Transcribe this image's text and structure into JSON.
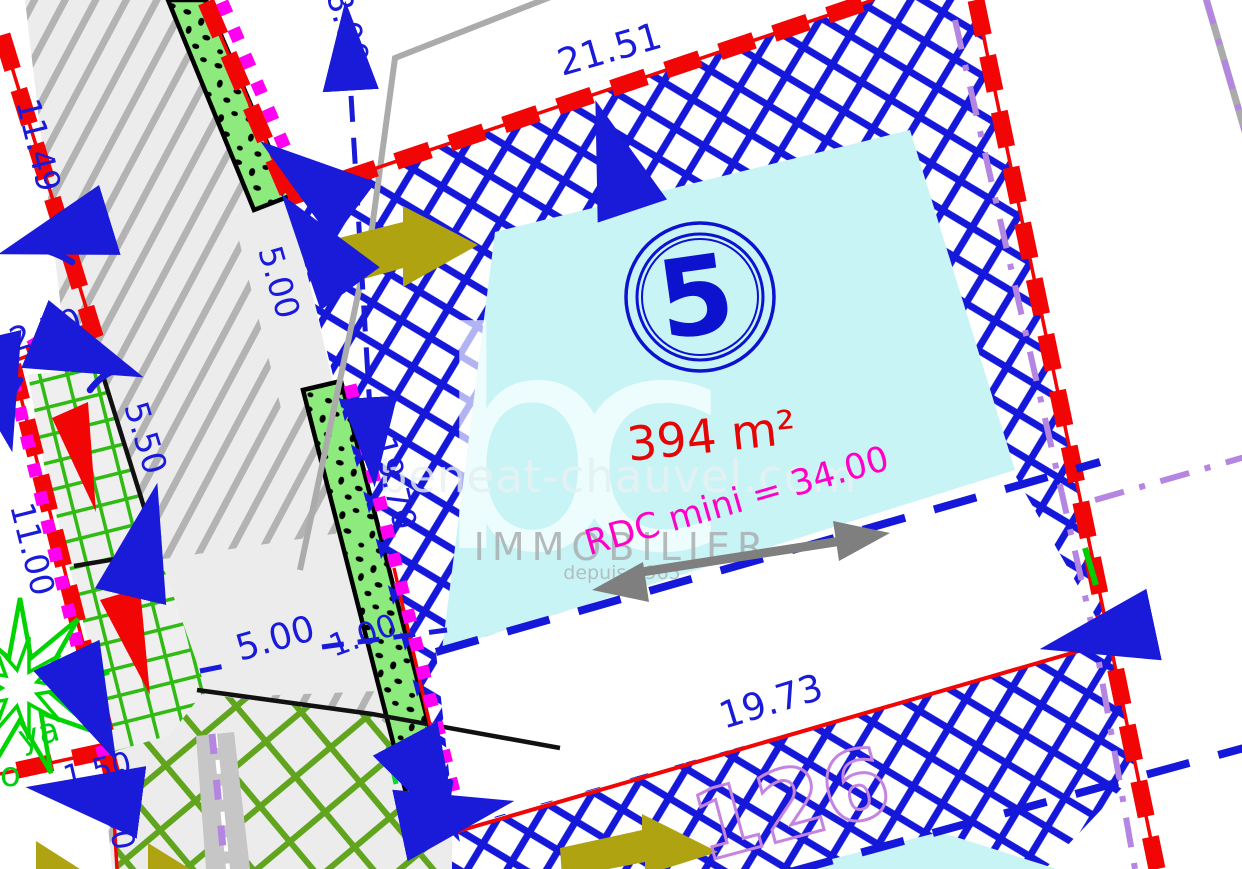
{
  "plan": {
    "lot": {
      "number": "5",
      "area": "394 m²",
      "constraint": "RDC mini = 34.00"
    },
    "adjacent_lot_number": "126",
    "dimensions": {
      "top_setback": "8.00",
      "north_boundary": "21.51",
      "west_boundary_1": "11.49",
      "west_boundary_2": "2.50",
      "access_width_north": "5.00",
      "hedge_offset": "5.50",
      "west_boundary_3": "11.00",
      "west_frontage": "19.70",
      "access_width_south": "5.00",
      "hedge_width": "1.00",
      "south_offset": "1.50",
      "south_west_boundary": "5.00",
      "south_boundary": "19.73"
    },
    "vegetation_label_fragment_1": "ya",
    "vegetation_label_fragment_2": "o",
    "watermark": {
      "logo": "bc",
      "website": "beneat-chauvel.com",
      "brand": "IMMOBILIER",
      "tagline": "depuis 1965"
    },
    "colors": {
      "boundary_red": "#f20505",
      "dimension_blue": "#1a1ad9",
      "crosshatch_blue": "#1518d8",
      "buildable_cyan": "#c9f4f6",
      "hedge_green": "#8deb7d",
      "grass_grid_green": "#2fbb12",
      "grass_grid_green_2": "#61a51e",
      "road_gray": "#ececec",
      "road_hatch_gray": "#b3b3b3",
      "utility_magenta": "#ff00f0",
      "note_magenta": "#ff00c8",
      "area_red": "#e60505",
      "adjacent_lot_violet": "#c584e0",
      "easement_violet": "#b585e2",
      "access_olive": "#b0a312",
      "tree_green": "#00d400",
      "watermark_gray": "#a3a3a3"
    }
  }
}
